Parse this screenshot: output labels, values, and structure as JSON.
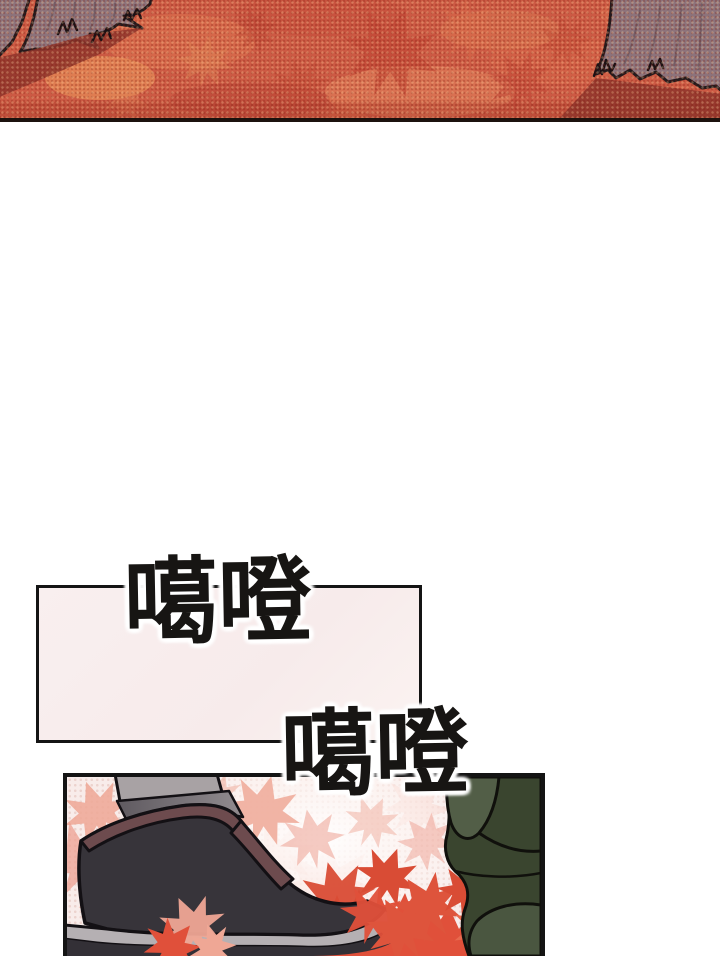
{
  "page": {
    "type": "comic-page",
    "width_px": 720,
    "height_px": 956,
    "background": "#ffffff"
  },
  "sfx": {
    "first": {
      "text": "噶噔"
    },
    "second": {
      "text": "噶噔"
    }
  },
  "panels": {
    "forest": {
      "label": "autumn forest floor covered in red maple leaves with two tree trunks"
    },
    "caption": {
      "label": "empty pale-pink caption box with black border"
    },
    "boot": {
      "label": "black boot stepping onto red maple leaves beside a dark green cloak"
    }
  },
  "palette": {
    "ground_red": "#cd5a44",
    "ground_light": "#e89068",
    "ground_deep": "#b84233",
    "shadow_red": "#8e352b",
    "trunk": "#8d737b",
    "trunk_shade": "#6e5861",
    "panel_pink": "#f8ecea",
    "halftone_pink": "#ecd3ce",
    "pale_leaf": "#efa795",
    "red_leaf": "#e0503a",
    "boot_black": "#37343a",
    "boot_trim": "#6d4b4e",
    "sole_gray": "#b5b0b3",
    "leg_gray": "#a8a2a4",
    "leg_shadow": "#6f6a70",
    "cloak_green_dark": "#3a452f",
    "cloak_green_light": "#525e47",
    "ink": "#141414"
  }
}
